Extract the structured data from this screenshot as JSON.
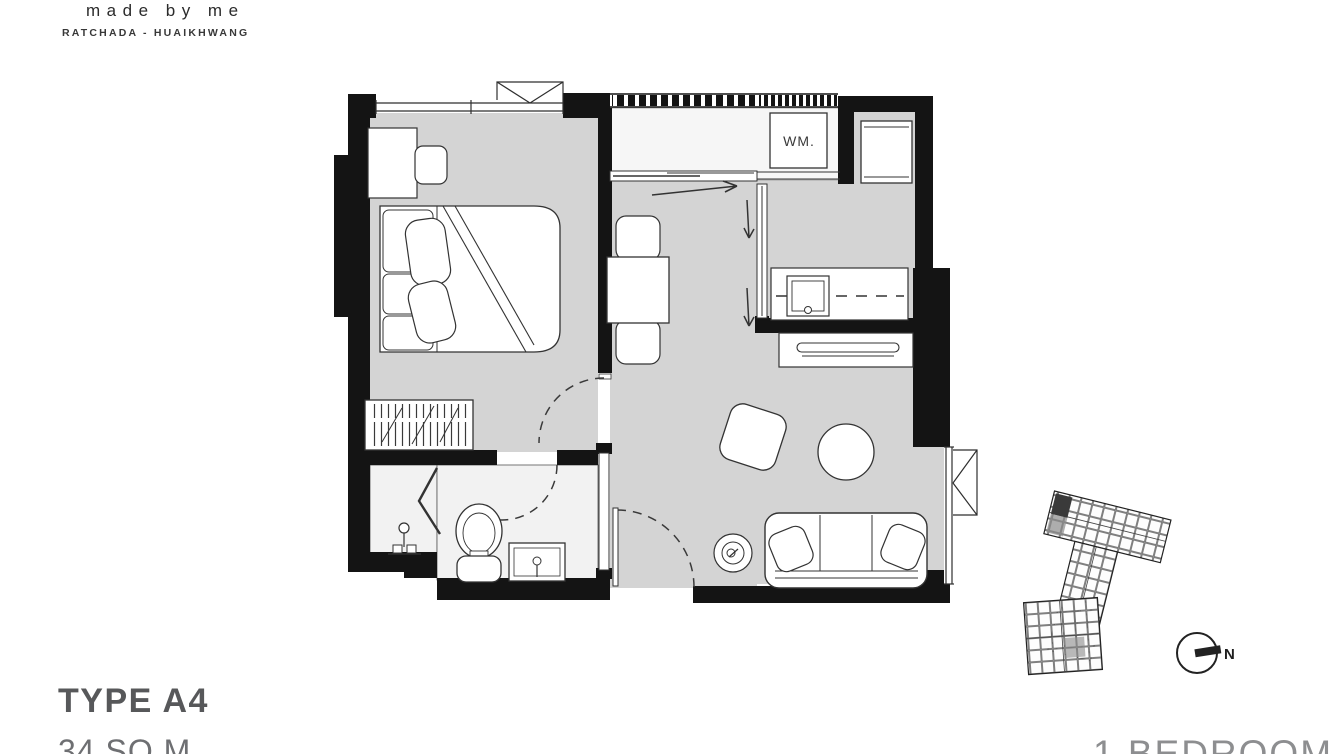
{
  "brand": {
    "wordmark": "made by me",
    "location": "RATCHADA - HUAIKHWANG"
  },
  "unit": {
    "type_label": "TYPE A4",
    "area_label": "34 SQ.M",
    "bedroom_label": "1 BEDROOM"
  },
  "floorplan": {
    "washer_label": "WM."
  },
  "compass": {
    "north_label": "N"
  },
  "colors": {
    "wall": "#141414",
    "floor_gray": "#d4d4d4",
    "floor_light": "#f2f2f2",
    "line": "#2f2f2f",
    "type_text": "#57585a",
    "area_text": "#6e6f72",
    "bedroom_text": "#8d8e90"
  }
}
